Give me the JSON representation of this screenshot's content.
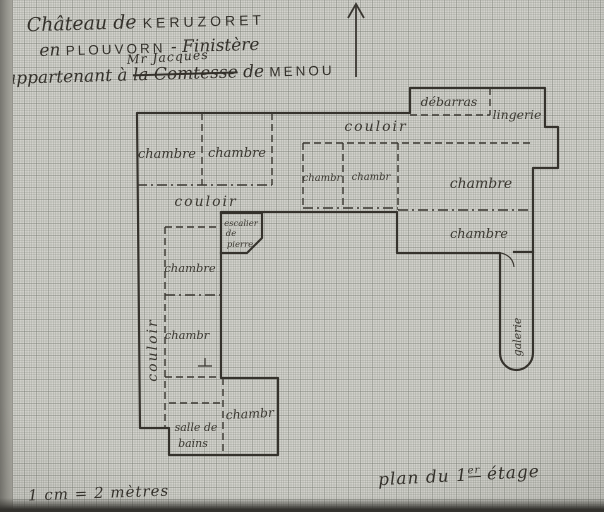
{
  "title": {
    "line1_script": "Château de",
    "line1_caps": "KERUZORET",
    "line2_pre": "en",
    "line2_caps": "PLOUVORN",
    "line2_dash": "-",
    "line2_script": "Finistère",
    "line3_pre": "appartenant à",
    "line3_struck": "la Comtesse",
    "line3_insertion": "Mr Jacques",
    "line3_mid": "de",
    "line3_caps": "MENOU"
  },
  "rooms": {
    "chambre_nw_1": "chambre",
    "chambre_nw_2": "chambre",
    "couloir_top": "couloir",
    "debarras": "débarras",
    "lingerie": "lingerie",
    "chambre_mid_1": "chambr",
    "chambre_mid_2": "chambr",
    "chambre_e_upper": "chambre",
    "chambre_e_lower": "chambre",
    "couloir_mid": "couloir",
    "escalier_l1": "escalier",
    "escalier_l2": "de",
    "escalier_l3": "pierre",
    "chambre_w_upper": "chambre",
    "chambre_w_lower": "chambr",
    "couloir_w": "couloir",
    "salle_de_bains_l1": "salle de",
    "salle_de_bains_l2": "bains",
    "chambre_s": "chambr",
    "galerie": "galerie"
  },
  "annotations": {
    "scale_note": "1 cm = 2 mètres",
    "caption_pre": "plan du 1",
    "caption_sup": "er",
    "caption_post": " étage"
  },
  "colors": {
    "paper": "#d2d2cc",
    "ink": "#34312b",
    "wall": "#35322c"
  }
}
